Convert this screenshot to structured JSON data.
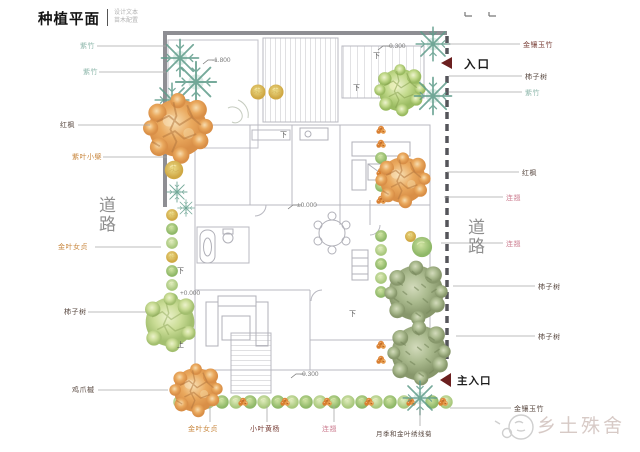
{
  "title": {
    "main": "种植平面",
    "sub1": "设计文本",
    "sub2": "苗木配置"
  },
  "roads": {
    "left": "道路",
    "right": "道路"
  },
  "entrances": {
    "side": "入口",
    "main": "主入口"
  },
  "watermark": {
    "brand": "乡土殊舍"
  },
  "levels": {
    "upper_terrace": "-1.800",
    "north_entry": "-0.300",
    "indoor": "±0.000",
    "west_patio": "+0.000",
    "south_patio": "-0.300"
  },
  "stairs": {
    "down": "下",
    "up": "上"
  },
  "plants": {
    "left": [
      {
        "name": "紫竹"
      },
      {
        "name": "紫竹"
      },
      {
        "name": "红枫"
      },
      {
        "name": "紫叶小檗"
      },
      {
        "name": "金叶女贞"
      },
      {
        "name": "柿子树"
      },
      {
        "name": "鸡爪槭"
      }
    ],
    "right": [
      {
        "name": "金镶玉竹"
      },
      {
        "name": "柿子树"
      },
      {
        "name": "紫竹"
      },
      {
        "name": "红枫"
      },
      {
        "name": "连翘"
      },
      {
        "name": "连翘"
      },
      {
        "name": "柿子树"
      },
      {
        "name": "柿子树"
      },
      {
        "name": "金镶玉竹"
      }
    ],
    "bottom": [
      {
        "name": "金叶女贞"
      },
      {
        "name": "小叶黄杨"
      },
      {
        "name": "连翘"
      },
      {
        "name": "月季和金叶绣线菊"
      }
    ]
  },
  "colors": {
    "accent_maroon": "#6b1f1f",
    "label_teal": "#8fb8ac",
    "label_orange": "#c8863c",
    "label_pink": "#cf8496",
    "road_gray": "#8f8f8f",
    "wall_gray": "#8e8e93"
  }
}
